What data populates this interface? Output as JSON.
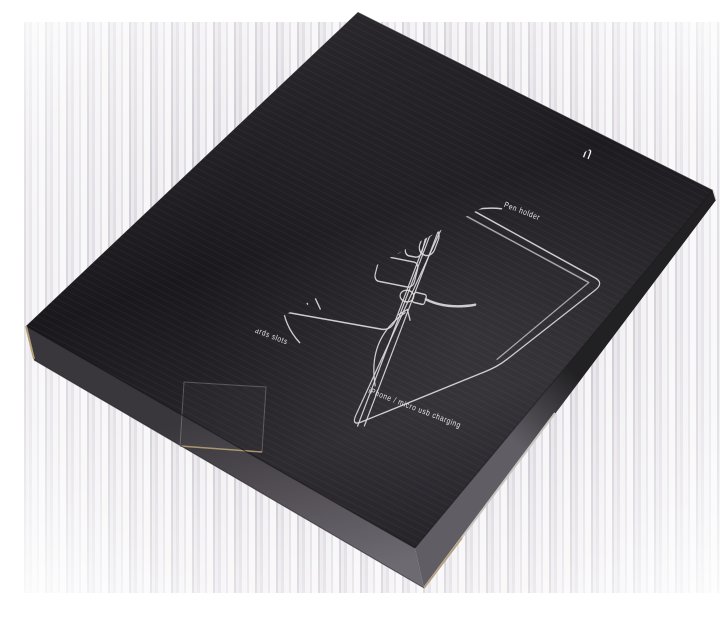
{
  "scene": {
    "description": "Photo of a black cardboard product box at an angle with white line diagram print",
    "background_color": "#ffffff",
    "artifact_stripe_colors": [
      "#948a9b",
      "#c9c3cf",
      "#a8a0af",
      "#dbd6df"
    ]
  },
  "box": {
    "surface_color": "#1e1b20",
    "side_color": "#5d5a62",
    "kraft_edge_color": "#b49e76",
    "print_color": "#dcdadc"
  },
  "print": {
    "title": "Powerbank Collection",
    "labels": {
      "touch_screen_pocket": "touch screen pocket",
      "smart_grip": "Smart grip",
      "pen_holder": "Pen holder",
      "id_card_holder": "ID card holder",
      "four_card_slots": "4 cards slots",
      "charging": "iPhone / micro usb charging"
    }
  }
}
